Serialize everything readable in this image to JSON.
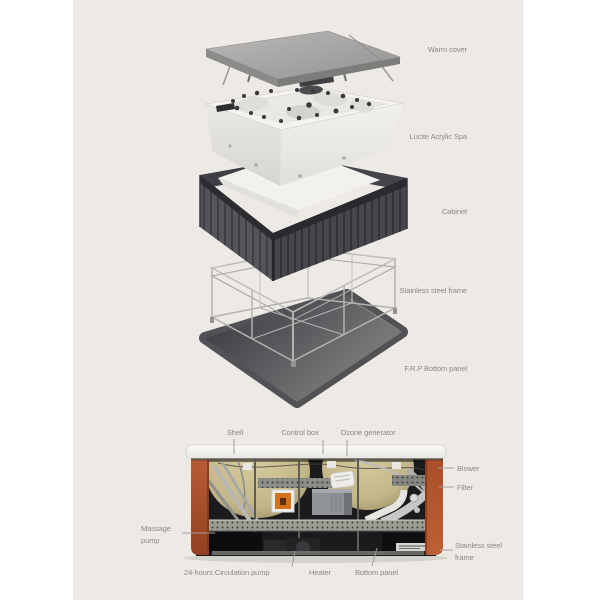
{
  "title": "Spa construction diagram",
  "exploded_view": {
    "labels": {
      "warm_cover": "Warm cover",
      "acrylic_spa": "Lucite Acrylic Spa",
      "cabinet": "Cabinet",
      "steel_frame": "Stainless steel frame",
      "frp_panel": "F.R.P Bottom panel"
    }
  },
  "cross_section": {
    "labels": {
      "shell": "Shell",
      "control_box": "Control box",
      "ozone_generator": "Ozone generator",
      "blower": "Blower",
      "filter": "Filter",
      "massage_pump": "Massage pump",
      "stainless_steel_frame": "Stainless steel frame",
      "circulation_pump": "24-hours Circulation pump",
      "heater": "Heater",
      "bottom_panel": "Bottom panel"
    }
  },
  "colors": {
    "canvas_background": "#edeae5",
    "label_text": "#8c8883",
    "cabinet_corner_terracotta": "#b25331",
    "orange_equipment_box": "#d4731c",
    "shell_insulation_beige": "#cdc293",
    "warm_cover_gray": "#a7a6a4",
    "cabinet_wood_gray": "#4b4c50",
    "frp_panel_gray": "#515256",
    "rim_white": "#f6f5f1"
  }
}
